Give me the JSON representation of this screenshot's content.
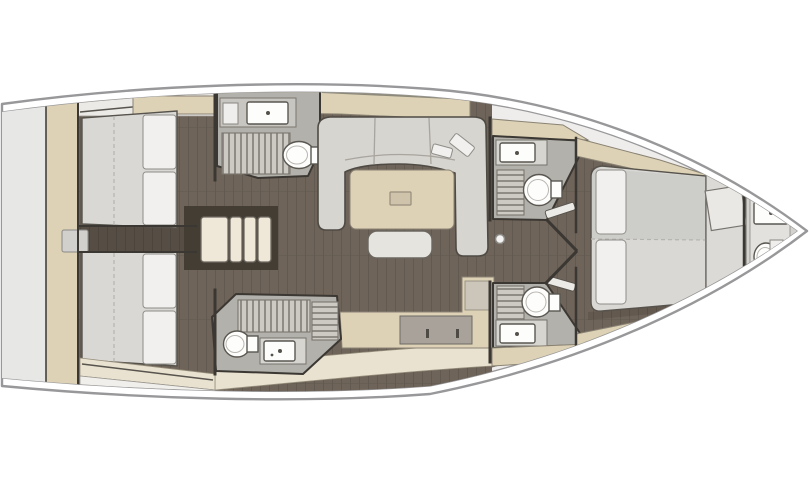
{
  "figure": {
    "type": "yacht-interior-floor-plan",
    "view": "top-down",
    "rooms": [
      "aft-cabin-starboard",
      "aft-cabin-port",
      "aft-head-starboard",
      "aft-head-port",
      "salon",
      "galley",
      "companionway-stairs",
      "forward-head-starboard",
      "forward-head-port",
      "forward-cabin",
      "bow-head",
      "stern-platform"
    ]
  },
  "colors": {
    "bg": "#ffffff",
    "hull-line": "#98989a",
    "interior-base": "#efedeb",
    "floor": "#6f6459",
    "floor-seam": "#625950",
    "seam-line": "#b5b3ae",
    "wall": "#3b3732",
    "beige": "#ddd2b6",
    "beige-light": "#e9e2d0",
    "steps": "#efe8d8",
    "opening": "#433d34",
    "bed": "#d9d8d4",
    "pillow": "#f1f0ee",
    "sofa": "#d7d5d0",
    "head-floor": "#b3b1ab",
    "grate": "#cdcac4",
    "grate-line": "#8f8c86",
    "fixture-white": "#fdfdfc",
    "fixture-line": "#5a5751",
    "counter-top": "#d7d5d0",
    "counter-gray": "#a8a29b",
    "window-strip": "#8d8a7c",
    "stern-gray": "#e7e7e5",
    "hatch-gray": "#d2d0cd",
    "door": "#e6ddc6",
    "bow-base": "#d4d2ce",
    "bow-inner": "#e3e1de",
    "headboard": "#dbdad6"
  }
}
